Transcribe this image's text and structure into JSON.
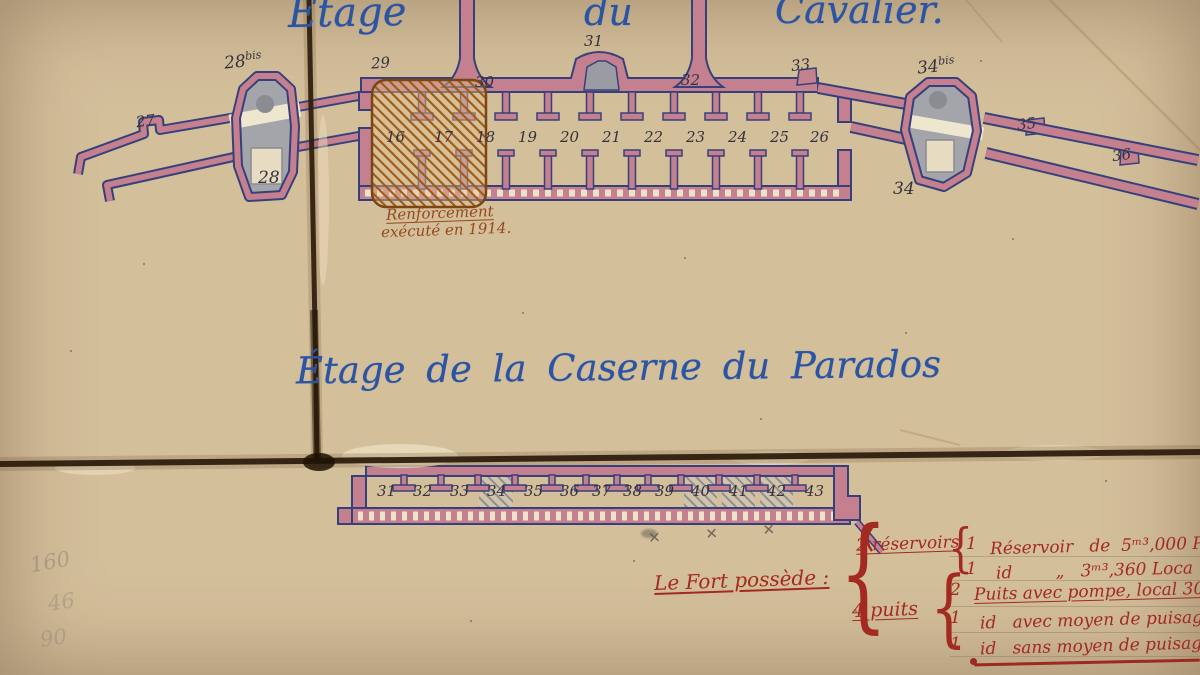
{
  "titles": {
    "etage": "Étage",
    "du": "du",
    "cavalier": "Cavalier.",
    "parados": "Étage de la Caserne du Parados"
  },
  "reinforcement": {
    "line1": "Renforcement",
    "line2": "exécuté en 1914."
  },
  "cavalier_plan": {
    "g27": "27",
    "g28bis": "28",
    "g28bis_sup": "bis",
    "g28": "28",
    "g29": "29",
    "g30": "30",
    "g31": "31",
    "g32": "32",
    "g33": "33",
    "g34bis": "34",
    "g34bis_sup": "bis",
    "g34": "34",
    "g35": "35",
    "g36": "36",
    "casemate_rooms": [
      "16",
      "17",
      "18",
      "19",
      "20",
      "21",
      "22",
      "23",
      "24",
      "25",
      "26"
    ]
  },
  "parados_plan": {
    "rooms": [
      "31",
      "32",
      "33",
      "34",
      "35",
      "36",
      "37",
      "38",
      "39",
      "40",
      "41",
      "42",
      "43"
    ]
  },
  "fort_notes": {
    "intro": "Le Fort possède :",
    "brace": "{",
    "reservoirs_qty_label": "2 réservoirs",
    "res_row1_n": "1",
    "res_row1_text": "Réservoir   de  5ᵐ³,000 Puisa",
    "res_row2_n": "1",
    "res_row2_text": "id        „   3ᵐ³,360 Loca",
    "puits_qty_label": "4 puits",
    "puits_row1_n": "2",
    "puits_row1_text": "Puits avec pompe, local 30",
    "puits_row2_n": "1",
    "puits_row2_text": "id   avec moyen de puisage à 1",
    "puits_row3_n": "1",
    "puits_row3_text": "id   sans moyen de puisage, 1"
  },
  "pencil": {
    "crosses": "✕ ✕ ✕",
    "s1": "160",
    "s2": "46",
    "s3": "90"
  }
}
